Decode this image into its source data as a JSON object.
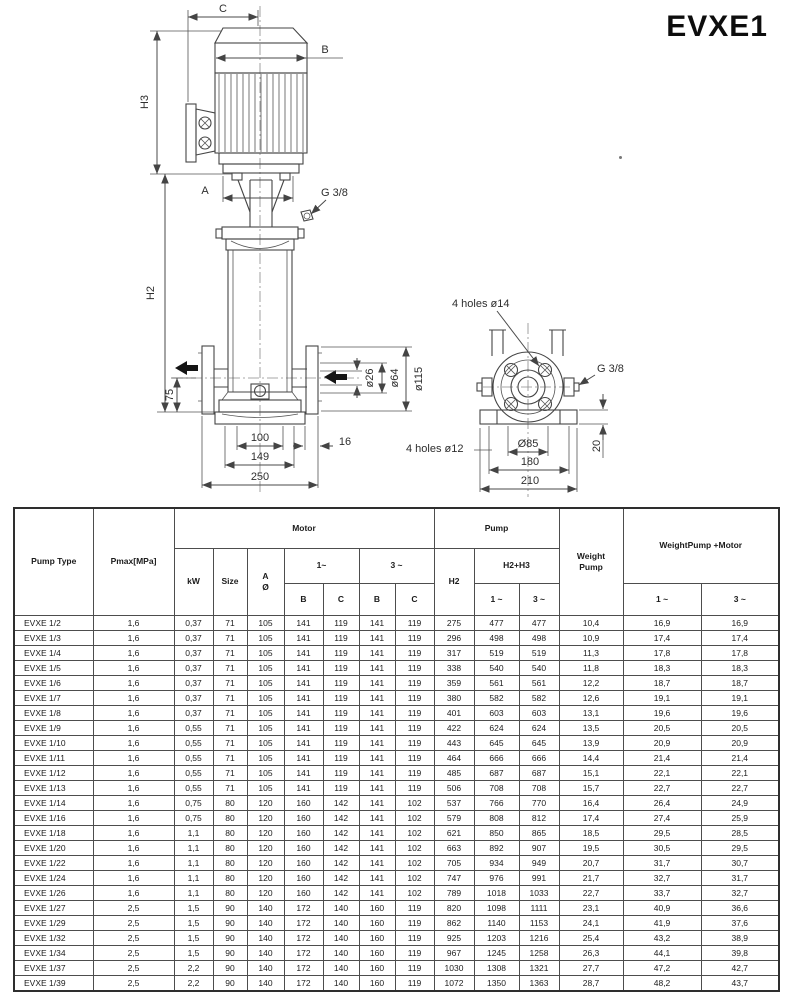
{
  "title": "EVXE1",
  "drawing": {
    "front": {
      "c": "C",
      "b": "B",
      "h3": "H3",
      "a": "A",
      "g38": "G 3/8",
      "h2": "H2",
      "d75": "75",
      "d26": "ø26",
      "d64": "ø64",
      "d115": "ø115",
      "d100": "100",
      "d149": "149",
      "d250": "250",
      "d16": "16"
    },
    "base": {
      "holes14": "4 holes ø14",
      "g38": "G 3/8",
      "holes12": "4 holes ø12",
      "d85": "Ø85",
      "d180": "180",
      "d210": "210",
      "d20": "20"
    }
  },
  "table": {
    "headers": {
      "pump_type": "Pump Type",
      "pmax": "Pmax[MPa]",
      "motor": "Motor",
      "kw": "kW",
      "size": "Size",
      "a1": "A",
      "a2": "Ø",
      "one_phase": "1~",
      "three_phase": "3 ~",
      "b": "B",
      "c": "C",
      "h2": "H2",
      "pump": "Pump",
      "h2h3": "H2+H3",
      "p1": "1 ~",
      "p3": "3 ~",
      "weight1": "Weight",
      "weight2": "Pump",
      "weight_pm": "WeightPump +Motor",
      "w1": "1 ~",
      "w3": "3 ~"
    },
    "rows": [
      [
        "EVXE 1/2",
        "1,6",
        "0,37",
        "71",
        "105",
        "141",
        "119",
        "141",
        "119",
        "275",
        "477",
        "477",
        "10,4",
        "16,9",
        "16,9"
      ],
      [
        "EVXE 1/3",
        "1,6",
        "0,37",
        "71",
        "105",
        "141",
        "119",
        "141",
        "119",
        "296",
        "498",
        "498",
        "10,9",
        "17,4",
        "17,4"
      ],
      [
        "EVXE 1/4",
        "1,6",
        "0,37",
        "71",
        "105",
        "141",
        "119",
        "141",
        "119",
        "317",
        "519",
        "519",
        "11,3",
        "17,8",
        "17,8"
      ],
      [
        "EVXE 1/5",
        "1,6",
        "0,37",
        "71",
        "105",
        "141",
        "119",
        "141",
        "119",
        "338",
        "540",
        "540",
        "11,8",
        "18,3",
        "18,3"
      ],
      [
        "EVXE 1/6",
        "1,6",
        "0,37",
        "71",
        "105",
        "141",
        "119",
        "141",
        "119",
        "359",
        "561",
        "561",
        "12,2",
        "18,7",
        "18,7"
      ],
      [
        "EVXE 1/7",
        "1,6",
        "0,37",
        "71",
        "105",
        "141",
        "119",
        "141",
        "119",
        "380",
        "582",
        "582",
        "12,6",
        "19,1",
        "19,1"
      ],
      [
        "EVXE 1/8",
        "1,6",
        "0,37",
        "71",
        "105",
        "141",
        "119",
        "141",
        "119",
        "401",
        "603",
        "603",
        "13,1",
        "19,6",
        "19,6"
      ],
      [
        "EVXE 1/9",
        "1,6",
        "0,55",
        "71",
        "105",
        "141",
        "119",
        "141",
        "119",
        "422",
        "624",
        "624",
        "13,5",
        "20,5",
        "20,5"
      ],
      [
        "EVXE 1/10",
        "1,6",
        "0,55",
        "71",
        "105",
        "141",
        "119",
        "141",
        "119",
        "443",
        "645",
        "645",
        "13,9",
        "20,9",
        "20,9"
      ],
      [
        "EVXE 1/11",
        "1,6",
        "0,55",
        "71",
        "105",
        "141",
        "119",
        "141",
        "119",
        "464",
        "666",
        "666",
        "14,4",
        "21,4",
        "21,4"
      ],
      [
        "EVXE 1/12",
        "1,6",
        "0,55",
        "71",
        "105",
        "141",
        "119",
        "141",
        "119",
        "485",
        "687",
        "687",
        "15,1",
        "22,1",
        "22,1"
      ],
      [
        "EVXE 1/13",
        "1,6",
        "0,55",
        "71",
        "105",
        "141",
        "119",
        "141",
        "119",
        "506",
        "708",
        "708",
        "15,7",
        "22,7",
        "22,7"
      ],
      [
        "EVXE 1/14",
        "1,6",
        "0,75",
        "80",
        "120",
        "160",
        "142",
        "141",
        "102",
        "537",
        "766",
        "770",
        "16,4",
        "26,4",
        "24,9"
      ],
      [
        "EVXE 1/16",
        "1,6",
        "0,75",
        "80",
        "120",
        "160",
        "142",
        "141",
        "102",
        "579",
        "808",
        "812",
        "17,4",
        "27,4",
        "25,9"
      ],
      [
        "EVXE 1/18",
        "1,6",
        "1,1",
        "80",
        "120",
        "160",
        "142",
        "141",
        "102",
        "621",
        "850",
        "865",
        "18,5",
        "29,5",
        "28,5"
      ],
      [
        "EVXE 1/20",
        "1,6",
        "1,1",
        "80",
        "120",
        "160",
        "142",
        "141",
        "102",
        "663",
        "892",
        "907",
        "19,5",
        "30,5",
        "29,5"
      ],
      [
        "EVXE 1/22",
        "1,6",
        "1,1",
        "80",
        "120",
        "160",
        "142",
        "141",
        "102",
        "705",
        "934",
        "949",
        "20,7",
        "31,7",
        "30,7"
      ],
      [
        "EVXE 1/24",
        "1,6",
        "1,1",
        "80",
        "120",
        "160",
        "142",
        "141",
        "102",
        "747",
        "976",
        "991",
        "21,7",
        "32,7",
        "31,7"
      ],
      [
        "EVXE 1/26",
        "1,6",
        "1,1",
        "80",
        "120",
        "160",
        "142",
        "141",
        "102",
        "789",
        "1018",
        "1033",
        "22,7",
        "33,7",
        "32,7"
      ],
      [
        "EVXE 1/27",
        "2,5",
        "1,5",
        "90",
        "140",
        "172",
        "140",
        "160",
        "119",
        "820",
        "1098",
        "1111",
        "23,1",
        "40,9",
        "36,6"
      ],
      [
        "EVXE 1/29",
        "2,5",
        "1,5",
        "90",
        "140",
        "172",
        "140",
        "160",
        "119",
        "862",
        "1140",
        "1153",
        "24,1",
        "41,9",
        "37,6"
      ],
      [
        "EVXE 1/32",
        "2,5",
        "1,5",
        "90",
        "140",
        "172",
        "140",
        "160",
        "119",
        "925",
        "1203",
        "1216",
        "25,4",
        "43,2",
        "38,9"
      ],
      [
        "EVXE 1/34",
        "2,5",
        "1,5",
        "90",
        "140",
        "172",
        "140",
        "160",
        "119",
        "967",
        "1245",
        "1258",
        "26,3",
        "44,1",
        "39,8"
      ],
      [
        "EVXE 1/37",
        "2,5",
        "2,2",
        "90",
        "140",
        "172",
        "140",
        "160",
        "119",
        "1030",
        "1308",
        "1321",
        "27,7",
        "47,2",
        "42,7"
      ],
      [
        "EVXE 1/39",
        "2,5",
        "2,2",
        "90",
        "140",
        "172",
        "140",
        "160",
        "119",
        "1072",
        "1350",
        "1363",
        "28,7",
        "48,2",
        "43,7"
      ]
    ]
  }
}
